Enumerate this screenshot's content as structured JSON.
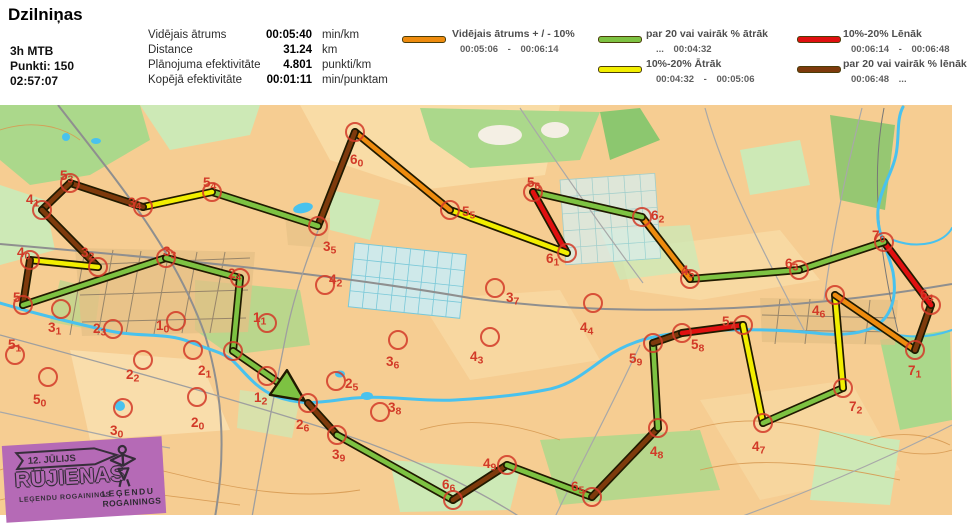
{
  "header": {
    "title": "Dzilniņas",
    "category": "3h MTB",
    "points": "Punkti: 150",
    "total_time": "02:57:07",
    "stats": [
      {
        "label": "Vidējais ātrums",
        "value": "00:05:40",
        "unit": "min/km"
      },
      {
        "label": "Distance",
        "value": "31.24",
        "unit": "km"
      },
      {
        "label": "Plānojuma efektivitāte",
        "value": "4.801",
        "unit": "punkti/km"
      },
      {
        "label": "Kopējā efektivitāte",
        "value": "00:01:11",
        "unit": "min/punktam"
      }
    ],
    "legend": [
      {
        "key": "avg",
        "label": "Vidējais ātrums + / - 10%",
        "range": "00:05:06 - 00:06:14"
      },
      {
        "key": "fastest",
        "label": "par 20 vai vairāk % ātrāk",
        "range": "... 00:04:32"
      },
      {
        "key": "fast",
        "label": "10%-20% Ātrāk",
        "range": "00:04:32 - 00:05:06"
      },
      {
        "key": "slow",
        "label": "10%-20% Lēnāk",
        "range": "00:06:14 - 00:06:48"
      },
      {
        "key": "slowest",
        "label": "par 20 vai vairāk % lēnāk",
        "range": "00:06:48 ..."
      }
    ]
  },
  "palette": {
    "avg": "#ee8b0e",
    "fastest": "#7dc242",
    "fast": "#f2ee00",
    "slow": "#e01010",
    "slowest": "#7e3a0c",
    "outline": "#201a00",
    "control": "#d23a28"
  },
  "map": {
    "controls": [
      {
        "id": "26",
        "x": 308,
        "y": 403,
        "lx": 296,
        "ly": 429
      },
      {
        "id": "39",
        "x": 337,
        "y": 435,
        "lx": 332,
        "ly": 459
      },
      {
        "id": "66",
        "x": 453,
        "y": 500,
        "lx": 442,
        "ly": 489
      },
      {
        "id": "49",
        "x": 507,
        "y": 465,
        "lx": 483,
        "ly": 468
      },
      {
        "id": "65",
        "x": 592,
        "y": 497,
        "lx": 571,
        "ly": 491
      },
      {
        "id": "48",
        "x": 658,
        "y": 428,
        "lx": 650,
        "ly": 456
      },
      {
        "id": "59",
        "x": 653,
        "y": 343,
        "lx": 629,
        "ly": 363
      },
      {
        "id": "58",
        "x": 682,
        "y": 333,
        "lx": 691,
        "ly": 349
      },
      {
        "id": "57",
        "x": 743,
        "y": 325,
        "lx": 722,
        "ly": 326
      },
      {
        "id": "47",
        "x": 763,
        "y": 423,
        "lx": 752,
        "ly": 451
      },
      {
        "id": "72",
        "x": 843,
        "y": 388,
        "lx": 849,
        "ly": 411
      },
      {
        "id": "46",
        "x": 835,
        "y": 295,
        "lx": 812,
        "ly": 315
      },
      {
        "id": "71",
        "x": 915,
        "y": 350,
        "lx": 908,
        "ly": 375
      },
      {
        "id": "64",
        "x": 931,
        "y": 305,
        "lx": 920,
        "ly": 299
      },
      {
        "id": "70",
        "x": 884,
        "y": 242,
        "lx": 872,
        "ly": 240
      },
      {
        "id": "63",
        "x": 799,
        "y": 270,
        "lx": 785,
        "ly": 268
      },
      {
        "id": "45",
        "x": 690,
        "y": 279,
        "lx": 681,
        "ly": 275
      },
      {
        "id": "62",
        "x": 642,
        "y": 217,
        "lx": 651,
        "ly": 220
      },
      {
        "id": "56",
        "x": 533,
        "y": 192,
        "lx": 527,
        "ly": 187
      },
      {
        "id": "61",
        "x": 567,
        "y": 253,
        "lx": 546,
        "ly": 263
      },
      {
        "id": "55",
        "x": 450,
        "y": 210,
        "lx": 462,
        "ly": 216
      },
      {
        "id": "60",
        "x": 355,
        "y": 132,
        "lx": 350,
        "ly": 164
      },
      {
        "id": "35",
        "x": 318,
        "y": 226,
        "lx": 323,
        "ly": 251
      },
      {
        "id": "54",
        "x": 212,
        "y": 192,
        "lx": 203,
        "ly": 187
      },
      {
        "id": "34",
        "x": 143,
        "y": 207,
        "lx": 128,
        "ly": 207
      },
      {
        "id": "53",
        "x": 70,
        "y": 183,
        "lx": 60,
        "ly": 180
      },
      {
        "id": "41",
        "x": 42,
        "y": 210,
        "lx": 26,
        "ly": 204
      },
      {
        "id": "32",
        "x": 98,
        "y": 267,
        "lx": 81,
        "ly": 257
      },
      {
        "id": "40",
        "x": 30,
        "y": 260,
        "lx": 17,
        "ly": 257
      },
      {
        "id": "5",
        "x": 23,
        "y": 305,
        "lx": 13,
        "ly": 302
      },
      {
        "id": "33",
        "x": 166,
        "y": 258,
        "lx": 163,
        "ly": 256
      },
      {
        "id": "24",
        "x": 240,
        "y": 278,
        "lx": 228,
        "ly": 278
      },
      {
        "id": "13",
        "x": 233,
        "y": 351,
        "hidden": true
      },
      {
        "id": "51",
        "x": 15,
        "y": 355,
        "lx": 8,
        "ly": 349
      },
      {
        "id": "50",
        "x": 48,
        "y": 377,
        "lx": 33,
        "ly": 404
      },
      {
        "id": "31",
        "x": 61,
        "y": 309,
        "lx": 48,
        "ly": 332
      },
      {
        "id": "23",
        "x": 113,
        "y": 329,
        "lx": 93,
        "ly": 333
      },
      {
        "id": "10",
        "x": 176,
        "y": 321,
        "lx": 156,
        "ly": 330
      },
      {
        "id": "21",
        "x": 193,
        "y": 350,
        "lx": 198,
        "ly": 375
      },
      {
        "id": "22",
        "x": 143,
        "y": 360,
        "lx": 126,
        "ly": 379
      },
      {
        "id": "20",
        "x": 197,
        "y": 397,
        "lx": 191,
        "ly": 427
      },
      {
        "id": "30",
        "x": 123,
        "y": 408,
        "lx": 110,
        "ly": 435
      },
      {
        "id": "11",
        "x": 267,
        "y": 323,
        "lx": 253,
        "ly": 322
      },
      {
        "id": "12",
        "x": 267,
        "y": 376,
        "lx": 254,
        "ly": 402
      },
      {
        "id": "42",
        "x": 325,
        "y": 285,
        "lx": 329,
        "ly": 284
      },
      {
        "id": "25",
        "x": 336,
        "y": 381,
        "lx": 345,
        "ly": 388
      },
      {
        "id": "38",
        "x": 380,
        "y": 412,
        "lx": 388,
        "ly": 412
      },
      {
        "id": "36",
        "x": 398,
        "y": 340,
        "lx": 386,
        "ly": 366
      },
      {
        "id": "43",
        "x": 490,
        "y": 337,
        "lx": 470,
        "ly": 361
      },
      {
        "id": "44",
        "x": 593,
        "y": 303,
        "lx": 580,
        "ly": 332
      },
      {
        "id": "37",
        "x": 495,
        "y": 288,
        "lx": 506,
        "ly": 302
      }
    ],
    "route": [
      {
        "from": "26",
        "to": "39",
        "speed": "slowest"
      },
      {
        "from": "39",
        "to": "66",
        "speed": "fastest"
      },
      {
        "from": "66",
        "to": "49",
        "speed": "slowest"
      },
      {
        "from": "49",
        "to": "65",
        "speed": "fastest"
      },
      {
        "from": "65",
        "to": "48",
        "speed": "slowest"
      },
      {
        "from": "48",
        "to": "59",
        "speed": "fastest"
      },
      {
        "from": "59",
        "to": "58",
        "speed": "slowest"
      },
      {
        "from": "58",
        "to": "57",
        "speed": "slow"
      },
      {
        "from": "57",
        "to": "47",
        "speed": "fast"
      },
      {
        "from": "47",
        "to": "72",
        "speed": "fastest"
      },
      {
        "from": "72",
        "to": "46",
        "speed": "fast"
      },
      {
        "from": "46",
        "to": "71",
        "speed": "avg"
      },
      {
        "from": "71",
        "to": "64",
        "speed": "slowest"
      },
      {
        "from": "64",
        "to": "70",
        "speed": "slow"
      },
      {
        "from": "70",
        "to": "63",
        "speed": "fastest"
      },
      {
        "from": "63",
        "to": "45",
        "speed": "fastest"
      },
      {
        "from": "45",
        "to": "62",
        "speed": "avg"
      },
      {
        "from": "62",
        "to": "56",
        "speed": "fastest"
      },
      {
        "from": "56",
        "to": "61",
        "speed": "slow"
      },
      {
        "from": "61",
        "to": "55",
        "speed": "fast"
      },
      {
        "from": "55",
        "to": "60",
        "speed": "avg"
      },
      {
        "from": "60",
        "to": "35",
        "speed": "slowest"
      },
      {
        "from": "35",
        "to": "54",
        "speed": "fastest"
      },
      {
        "from": "54",
        "to": "34",
        "speed": "fast"
      },
      {
        "from": "34",
        "to": "53",
        "speed": "slowest"
      },
      {
        "from": "53",
        "to": "41",
        "speed": "slowest"
      },
      {
        "from": "41",
        "to": "32",
        "speed": "slowest"
      },
      {
        "from": "32",
        "to": "40",
        "speed": "fast"
      },
      {
        "from": "40",
        "to": "5",
        "speed": "slowest"
      },
      {
        "from": "5",
        "to": "33",
        "speed": "fastest"
      },
      {
        "from": "33",
        "to": "24",
        "speed": "fastest"
      },
      {
        "from": "24",
        "to": "13",
        "speed": "fastest"
      }
    ],
    "finish_arrow": {
      "from": "13",
      "to": "26",
      "speed": "fastest"
    }
  },
  "banner": {
    "date": "12. JŪLIJS",
    "title": "RŪJIENAS",
    "subtitle": "LEĢENDU ROGAININGS",
    "logo_line1": "LEĢENDU",
    "logo_line2": "ROGAININGS"
  }
}
